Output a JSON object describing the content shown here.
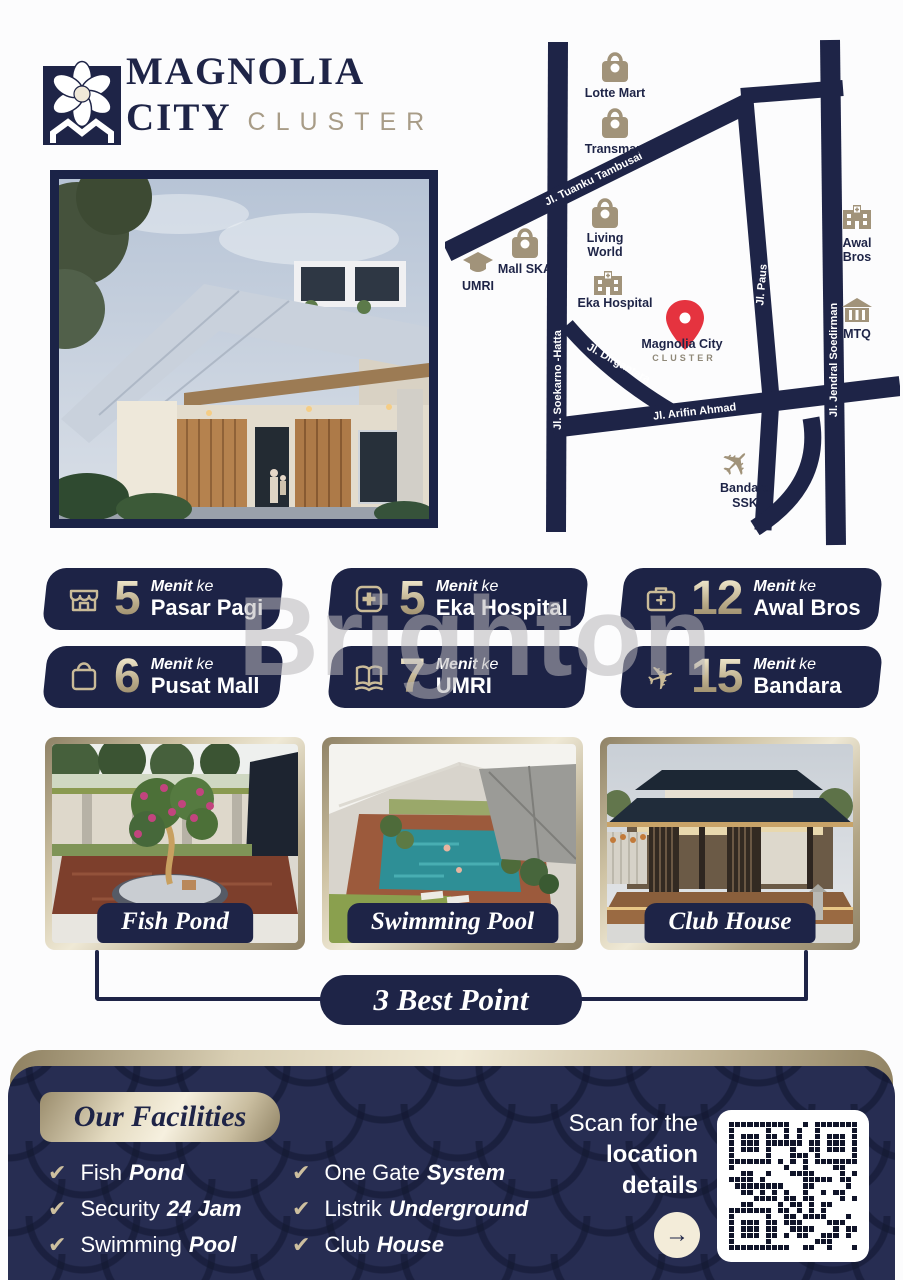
{
  "brand": {
    "line1": "MAGNOLIA",
    "line2": "CITY",
    "line3": "CLUSTER"
  },
  "map": {
    "roads": {
      "tambusai": "Jl. Tuanku Tambusai",
      "soekarno": "Jl. Soekarno -Hatta",
      "dirgantara": "Jl. Dirgantara",
      "arifin": "Jl. Arifin Ahmad",
      "paus": "Jl. Paus",
      "soedirman": "Jl. Jendral Soedirman"
    },
    "pois": [
      {
        "icon": "shopping-bag",
        "lines": [
          "Lotte Mart"
        ]
      },
      {
        "icon": "shopping-bag",
        "lines": [
          "Transmart"
        ]
      },
      {
        "icon": "shopping-bag",
        "lines": [
          "Living",
          "World"
        ]
      },
      {
        "icon": "shopping-bag",
        "lines": [
          "Mall SKA"
        ]
      },
      {
        "icon": "graduation-cap",
        "lines": [
          "UMRI"
        ]
      },
      {
        "icon": "hospital-building",
        "lines": [
          "Eka Hospital"
        ]
      },
      {
        "icon": "hospital-building",
        "lines": [
          "Awal",
          "Bros"
        ]
      },
      {
        "icon": "landmark-building",
        "lines": [
          "MTQ"
        ]
      },
      {
        "icon": "airplane",
        "lines": [
          "Bandara",
          "SSK"
        ]
      }
    ],
    "pin": {
      "label": "Magnolia City",
      "sublabel": "CLUSTER"
    }
  },
  "badges": {
    "menit": "Menit",
    "ke": "ke",
    "items": [
      {
        "icon": "storefront",
        "minutes": "5",
        "place": "Pasar Pagi"
      },
      {
        "icon": "medical-cross",
        "minutes": "5",
        "place": "Eka Hospital"
      },
      {
        "icon": "medical-bag",
        "minutes": "12",
        "place": "Awal Bros"
      },
      {
        "icon": "shopping-bag",
        "minutes": "6",
        "place": "Pusat Mall"
      },
      {
        "icon": "open-book",
        "minutes": "7",
        "place": "UMRI"
      },
      {
        "icon": "airplane",
        "minutes": "15",
        "place": "Bandara"
      }
    ]
  },
  "watermark": "Brighton",
  "photos": [
    {
      "caption": "Fish Pond"
    },
    {
      "caption": "Swimming Pool"
    },
    {
      "caption": "Club House"
    }
  ],
  "best_point": "3 Best Point",
  "facilities": {
    "title": "Our Facilities",
    "items": [
      {
        "pre": "Fish",
        "emph": "Pond"
      },
      {
        "pre": "Security",
        "emph": "24 Jam"
      },
      {
        "pre": "Swimming",
        "emph": "Pool"
      },
      {
        "pre": "One Gate",
        "emph": "System"
      },
      {
        "pre": "Listrik",
        "emph": "Underground"
      },
      {
        "pre": "Club",
        "emph": "House"
      }
    ]
  },
  "scan": {
    "line1": "Scan for the",
    "line2": "location",
    "line3": "details"
  },
  "colors": {
    "navy": "#1e2447",
    "tan": "#a1937a",
    "gold_light": "#efe9d6",
    "red_pin": "#e5333f",
    "panel_navy": "#272d52",
    "white": "#ffffff"
  }
}
